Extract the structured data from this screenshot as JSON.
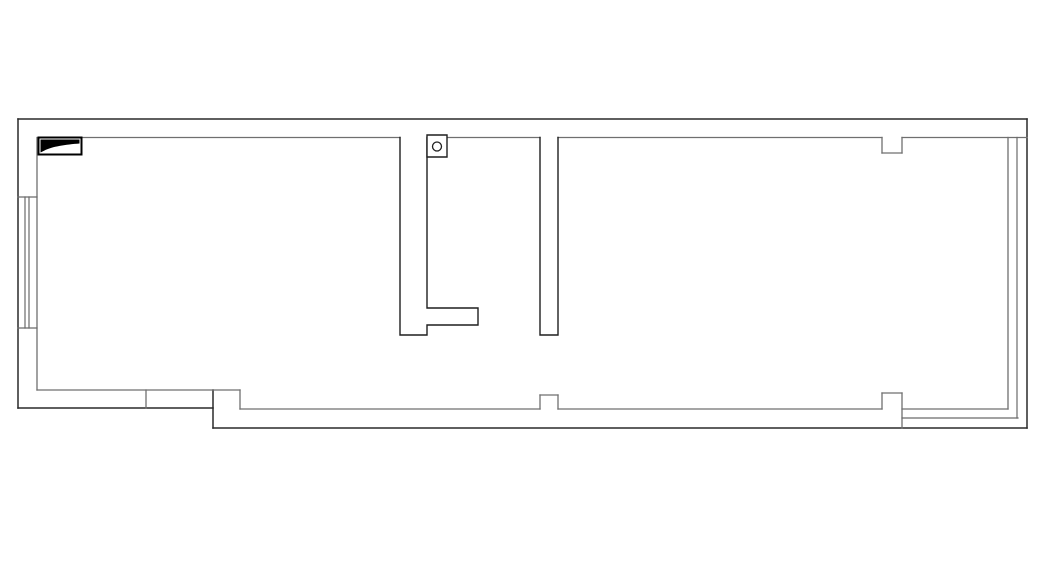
{
  "canvas": {
    "width": 1052,
    "height": 582,
    "background": "#ffffff"
  },
  "palette": {
    "outer": "#2a2a2a",
    "inner": "#6f6f6f",
    "partition": "#1f1f1f",
    "window": "#6a6a6a",
    "fixture": "#000000"
  },
  "floor_plan": {
    "description": "empty architectural floor plan, single elongated unit, no text labels",
    "segments": [
      {
        "name": "top-wall-outer",
        "x1": 18,
        "y1": 119,
        "x2": 1027,
        "y2": 119,
        "stroke": "outer",
        "w": 1.5
      },
      {
        "name": "left-wall-outer",
        "x1": 18,
        "y1": 119,
        "x2": 18,
        "y2": 408,
        "stroke": "outer",
        "w": 1.5
      },
      {
        "name": "bottom-left-wall-outer",
        "x1": 18,
        "y1": 408,
        "x2": 213,
        "y2": 408,
        "stroke": "outer",
        "w": 1.5
      },
      {
        "name": "bottom-step-outer",
        "x1": 213,
        "y1": 390,
        "x2": 213,
        "y2": 428,
        "stroke": "outer",
        "w": 1.5
      },
      {
        "name": "bottom-wall-outer",
        "x1": 213,
        "y1": 428,
        "x2": 1027,
        "y2": 428,
        "stroke": "outer",
        "w": 1.5
      },
      {
        "name": "right-wall-outer",
        "x1": 1027,
        "y1": 119,
        "x2": 1027,
        "y2": 428,
        "stroke": "outer",
        "w": 1.5
      },
      {
        "name": "top-wall-inner-1",
        "x1": 81.5,
        "y1": 137.5,
        "x2": 400,
        "y2": 137.5,
        "stroke": "inner",
        "w": 1.3
      },
      {
        "name": "top-wall-inner-2",
        "x1": 447,
        "y1": 137.5,
        "x2": 540,
        "y2": 137.5,
        "stroke": "inner",
        "w": 1.3
      },
      {
        "name": "top-wall-inner-3",
        "x1": 558,
        "y1": 137.5,
        "x2": 882,
        "y2": 137.5,
        "stroke": "inner",
        "w": 1.3
      },
      {
        "name": "top-wall-inner-4",
        "x1": 902,
        "y1": 137.5,
        "x2": 1027,
        "y2": 137.5,
        "stroke": "inner",
        "w": 1.3
      },
      {
        "name": "top-pier-left",
        "x1": 882,
        "y1": 137.5,
        "x2": 882,
        "y2": 153,
        "stroke": "inner",
        "w": 1.3
      },
      {
        "name": "top-pier-bottom",
        "x1": 882,
        "y1": 153,
        "x2": 902,
        "y2": 153,
        "stroke": "inner",
        "w": 1.3
      },
      {
        "name": "top-pier-right",
        "x1": 902,
        "y1": 153,
        "x2": 902,
        "y2": 137.5,
        "stroke": "inner",
        "w": 1.3
      },
      {
        "name": "left-wall-inner",
        "x1": 37,
        "y1": 137.5,
        "x2": 37,
        "y2": 390,
        "stroke": "inner",
        "w": 1.3
      },
      {
        "name": "left-window-sill-top",
        "x1": 18,
        "y1": 197,
        "x2": 37,
        "y2": 197,
        "stroke": "window",
        "w": 1.2
      },
      {
        "name": "left-window-sill-bottom",
        "x1": 18,
        "y1": 328,
        "x2": 37,
        "y2": 328,
        "stroke": "window",
        "w": 1.2
      },
      {
        "name": "left-window-glass-1",
        "x1": 25,
        "y1": 197,
        "x2": 25,
        "y2": 328,
        "stroke": "window",
        "w": 1.2
      },
      {
        "name": "left-window-glass-2",
        "x1": 29,
        "y1": 197,
        "x2": 29,
        "y2": 328,
        "stroke": "window",
        "w": 1.2
      },
      {
        "name": "bottom-left-wall-inner",
        "x1": 37,
        "y1": 390,
        "x2": 240,
        "y2": 390,
        "stroke": "inner",
        "w": 1.3
      },
      {
        "name": "bottom-left-divider",
        "x1": 146,
        "y1": 390,
        "x2": 146,
        "y2": 408,
        "stroke": "inner",
        "w": 1.3
      },
      {
        "name": "bottom-step-inner",
        "x1": 240,
        "y1": 390,
        "x2": 240,
        "y2": 409,
        "stroke": "inner",
        "w": 1.3
      },
      {
        "name": "bottom-wall-inner-1",
        "x1": 240,
        "y1": 409,
        "x2": 540,
        "y2": 409,
        "stroke": "inner",
        "w": 1.3
      },
      {
        "name": "bottom-pier1-left",
        "x1": 540,
        "y1": 409,
        "x2": 540,
        "y2": 395,
        "stroke": "inner",
        "w": 1.3
      },
      {
        "name": "bottom-pier1-top",
        "x1": 540,
        "y1": 395,
        "x2": 558,
        "y2": 395,
        "stroke": "inner",
        "w": 1.3
      },
      {
        "name": "bottom-pier1-right",
        "x1": 558,
        "y1": 395,
        "x2": 558,
        "y2": 409,
        "stroke": "inner",
        "w": 1.3
      },
      {
        "name": "bottom-wall-inner-2",
        "x1": 558,
        "y1": 409,
        "x2": 882,
        "y2": 409,
        "stroke": "inner",
        "w": 1.3
      },
      {
        "name": "bottom-pier2-left",
        "x1": 882,
        "y1": 409,
        "x2": 882,
        "y2": 393,
        "stroke": "inner",
        "w": 1.3
      },
      {
        "name": "bottom-pier2-top",
        "x1": 882,
        "y1": 393,
        "x2": 902,
        "y2": 393,
        "stroke": "inner",
        "w": 1.3
      },
      {
        "name": "bottom-pier2-right",
        "x1": 902,
        "y1": 393,
        "x2": 902,
        "y2": 428,
        "stroke": "inner",
        "w": 1.3
      },
      {
        "name": "bottom-wall-inner-3",
        "x1": 902,
        "y1": 409,
        "x2": 1008,
        "y2": 409,
        "stroke": "inner",
        "w": 1.3
      },
      {
        "name": "bottom-window-rail",
        "x1": 902,
        "y1": 418,
        "x2": 1018,
        "y2": 418,
        "stroke": "window",
        "w": 1.2
      },
      {
        "name": "right-window-glass-1",
        "x1": 1008,
        "y1": 137.5,
        "x2": 1008,
        "y2": 409,
        "stroke": "inner",
        "w": 1.3
      },
      {
        "name": "right-window-glass-2",
        "x1": 1017,
        "y1": 137.5,
        "x2": 1017,
        "y2": 418,
        "stroke": "window",
        "w": 1.2
      }
    ],
    "polylines": [
      {
        "name": "partition-wall-a",
        "stroke": "partition",
        "w": 1.4,
        "points": [
          [
            400,
            137.5
          ],
          [
            400,
            335
          ],
          [
            427,
            335
          ],
          [
            427,
            325
          ],
          [
            478,
            325
          ],
          [
            478,
            308
          ],
          [
            427,
            308
          ],
          [
            427,
            137.5
          ]
        ]
      },
      {
        "name": "partition-wall-b",
        "stroke": "partition",
        "w": 1.4,
        "points": [
          [
            540,
            137.5
          ],
          [
            540,
            335
          ],
          [
            558,
            335
          ],
          [
            558,
            137.5
          ]
        ]
      }
    ],
    "rects": [
      {
        "name": "flue-box",
        "x": 427,
        "y": 135,
        "w": 20,
        "h": 22,
        "stroke": "partition",
        "sw": 1.4,
        "fill": "#ffffff"
      },
      {
        "name": "corner-fixture",
        "x": 38.5,
        "y": 137.5,
        "w": 43,
        "h": 17,
        "stroke": "fixture",
        "sw": 2,
        "fill": "#ffffff"
      }
    ],
    "circles": [
      {
        "name": "flue-circle",
        "cx": 437,
        "cy": 146.5,
        "r": 4.5,
        "stroke": "partition",
        "sw": 1.3,
        "fill": "none"
      }
    ],
    "paths": [
      {
        "name": "corner-fixture-fill",
        "d": "M40.5,139.5 L79.5,139.5 L79.5,143.5 C66,144.5 52,146.5 44.5,150.5 L40.5,152.5 Z",
        "fill": "#000000",
        "stroke": "none",
        "sw": 0
      }
    ]
  }
}
